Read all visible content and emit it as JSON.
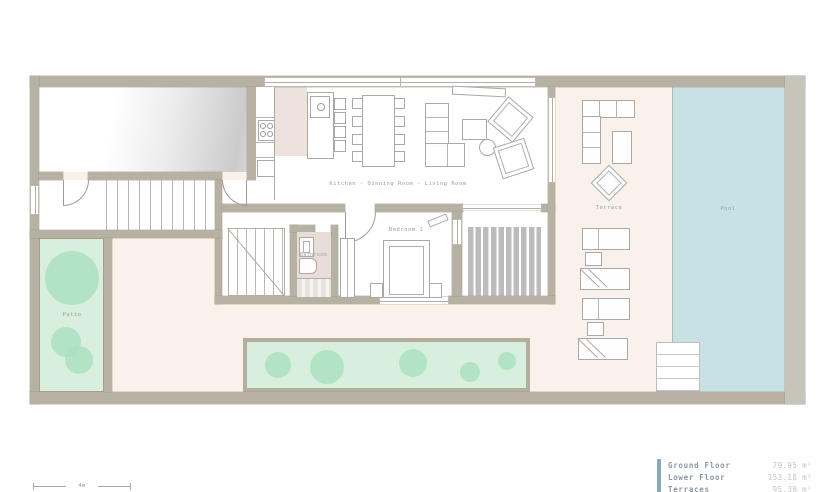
{
  "plan": {
    "room_labels": {
      "living": "Kitchen - Dinning Room - Living Room",
      "bedroom": "Bedroom 1",
      "bathroom": "Bathroom",
      "patio": "Patio",
      "terrace": "Terrace",
      "pool": "Pool"
    },
    "scale_bar": {
      "label": "4m"
    },
    "legend": {
      "items": [
        {
          "label": "Ground Floor",
          "value": "79.95 m²"
        },
        {
          "label": "Lower Floor",
          "value": "153.18 m²"
        },
        {
          "label": "Terraces",
          "value": "95.38 m²"
        }
      ],
      "accent_color": "#85abb8"
    },
    "colors": {
      "wall": "#b6b1a3",
      "terrace_floor": "#faf1ea",
      "pool_water": "#c8e1e5",
      "garden_green": "#d8efdd",
      "tree_green": "#a9e0bf",
      "kitchen_floor": "#eee2dc",
      "bathroom_floor": "#e9ded7",
      "deck_stripe": "#bcbcbc"
    }
  }
}
